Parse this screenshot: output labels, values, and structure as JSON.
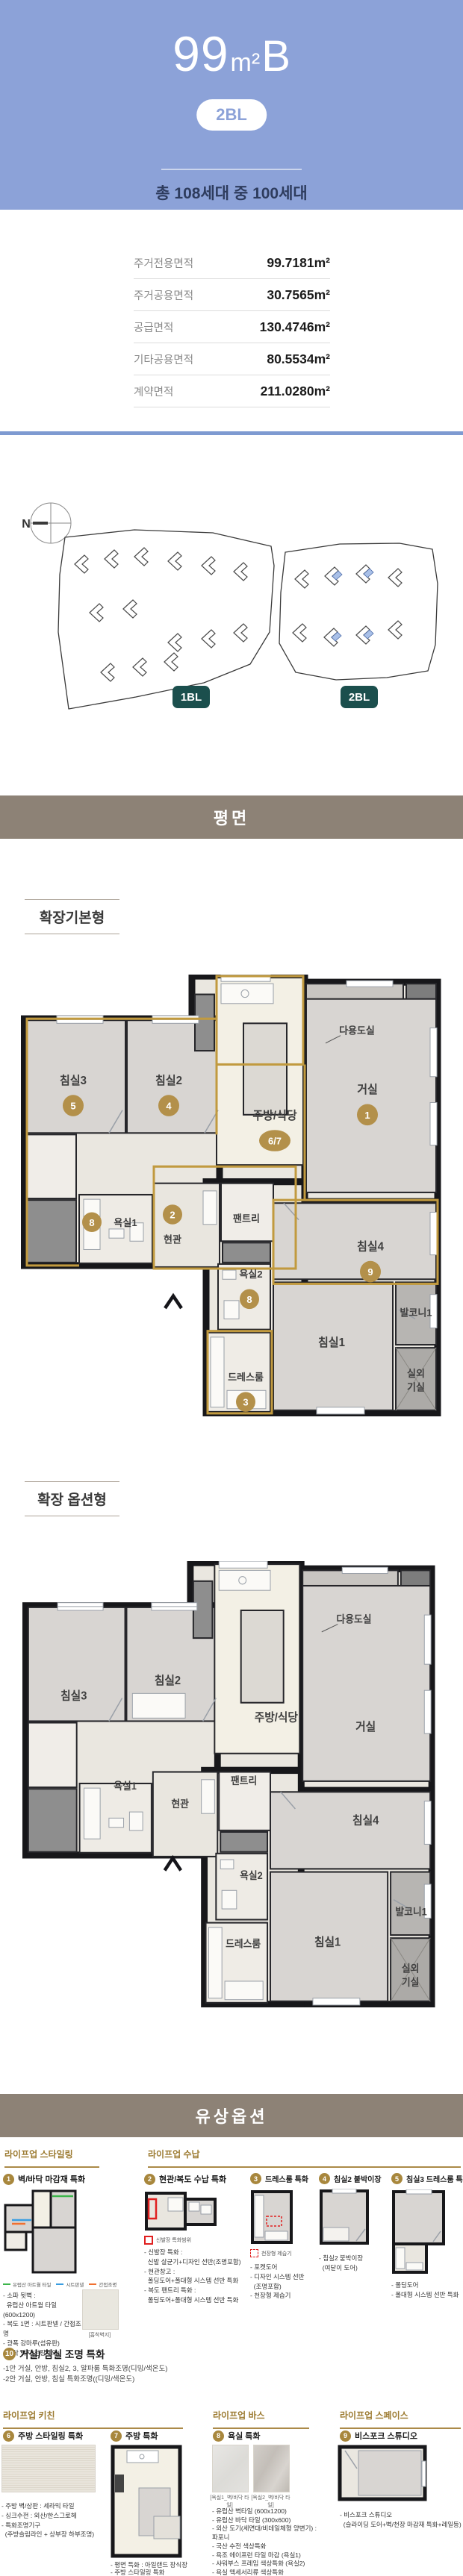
{
  "theme": {
    "header_bg": "#8CA2D8",
    "subtitle_text": "#2E3C5E",
    "band_bg": "#8D8276",
    "accent_gold": "#B3904A",
    "gold_line": "#C19A3F",
    "badge_teal": "#1B4F4D",
    "divider_blue": "#7E9AD1",
    "legend_green": "#3CB54A",
    "legend_blue": "#3B9DE0",
    "legend_orange": "#F07030",
    "legend_red": "#E02020",
    "wall": "#17171A"
  },
  "header": {
    "title_num": "99",
    "title_unit": "m²",
    "title_type": "B",
    "block_badge": "2BL",
    "subtitle": "총 108세대 중 100세대"
  },
  "area_table": {
    "rows": [
      {
        "label": "주거전용면적",
        "value": "99.7181m²"
      },
      {
        "label": "주거공용면적",
        "value": "30.7565m²"
      },
      {
        "label": "공급면적",
        "value": "130.4746m²"
      },
      {
        "label": "기타공용면적",
        "value": "80.5534m²"
      },
      {
        "label": "계약면적",
        "value": "211.0280m²"
      }
    ]
  },
  "site_plan": {
    "compass_label": "N",
    "badges": [
      "1BL",
      "2BL"
    ]
  },
  "sections": {
    "plan_band": "평면",
    "paid_band": "유상옵션"
  },
  "plan_basic": {
    "title": "확장기본형",
    "rooms": {
      "bed3": {
        "label": "침실3",
        "badge": "5"
      },
      "bed2": {
        "label": "침실2",
        "badge": "4"
      },
      "kitchen": {
        "label": "주방/식당",
        "badge": "6/7"
      },
      "living": {
        "label": "거실",
        "badge": "1"
      },
      "bath1": {
        "label": "욕실1",
        "badge": "8"
      },
      "entry": {
        "label": "현관",
        "badge": "2"
      },
      "pantry": {
        "label": "팬트리"
      },
      "bed4": {
        "label": "침실4",
        "badge": "9"
      },
      "bath2": {
        "label": "욕실2",
        "badge": "8"
      },
      "dress": {
        "label": "드레스룸",
        "badge": "3"
      },
      "bed1": {
        "label": "침실1"
      },
      "balcony": {
        "label": "발코니1"
      },
      "outdoor": {
        "label": "실외기실",
        "line1": "실외",
        "line2": "기실"
      },
      "utility": {
        "label": "다용도실"
      }
    }
  },
  "plan_option": {
    "title": "확장 옵션형",
    "rooms": {
      "bed3": {
        "label": "침실3"
      },
      "bed2": {
        "label": "침실2"
      },
      "kitchen": {
        "label": "주방/식당"
      },
      "living": {
        "label": "거실"
      },
      "bath1": {
        "label": "욕실1"
      },
      "entry": {
        "label": "현관"
      },
      "pantry": {
        "label": "팬트리"
      },
      "bed4": {
        "label": "침실4"
      },
      "bath2": {
        "label": "욕실2"
      },
      "dress": {
        "label": "드레스룸"
      },
      "bed1": {
        "label": "침실1"
      },
      "balcony": {
        "label": "발코니1"
      },
      "outdoor": {
        "label": "실외기실",
        "line1": "실외",
        "line2": "기실"
      },
      "utility": {
        "label": "다용도실"
      }
    }
  },
  "options": {
    "groups": {
      "styling": "라이프업 스타일링",
      "storage": "라이프업 수납",
      "kitchen": "라이프업 키친",
      "bath": "라이프업 바스",
      "space": "라이프업 스페이스"
    },
    "items": {
      "i1": {
        "num": "1",
        "title": "벽/바닥 마감재 특화",
        "legend": [
          {
            "color": "#3CB54A",
            "label": "유럽산 아트월 타일"
          },
          {
            "color": "#3B9DE0",
            "label": "시트판넬"
          },
          {
            "color": "#F07030",
            "label": "간접조명"
          }
        ],
        "bullets": [
          "- 소파 뒷벽 :",
          "  유럽산 아트월 타일(600x1200)",
          "- 복도 1면 : 시트판넬 / 간접조명",
          "- 광폭 강마루(섬유판)",
          "- 흡착 벽지(천장제외)"
        ],
        "sample_caption": "[흡착벽지]"
      },
      "i2": {
        "num": "2",
        "title": "현관/복도 수납 특화",
        "legend_label": "신발장 특화범위",
        "bullets": [
          "- 신발장 특화 :",
          "  신발 살균기+디자인 선반(조명포함)",
          "- 현관창고 :",
          "  폴딩도어+폴대형 시스템 선반 특화",
          "- 복도 팬트리 특화 :",
          "  폴딩도어+폴대형 시스템 선반 특화"
        ]
      },
      "i3": {
        "num": "3",
        "title": "드레스룸 특화",
        "legend_label": "천장형 제습기",
        "bullets": [
          "- 포켓도어",
          "- 디자인 시스템 선반",
          "  (조명포함)",
          "- 천장형 제습기"
        ]
      },
      "i4": {
        "num": "4",
        "title": "침실2 붙박이장",
        "bullets": [
          "- 침실2 붙박이장",
          "  (여닫이 도어)"
        ]
      },
      "i5": {
        "num": "5",
        "title": "침실3 드레스룸 특화",
        "bullets": [
          "- 폴딩도어",
          "- 폴대형 시스템 선반 특화"
        ]
      },
      "i10": {
        "num": "10",
        "title": "거실/ 침실 조명 특화",
        "bullets": [
          "-1안 거실, 안방, 침실2, 3, 알파룸 특화조명(디밍/색온도)",
          "-2안 거실, 안방, 침실 특화조명((디밍/색온도)"
        ]
      },
      "i6": {
        "num": "6",
        "title": "주방 스타일링 특화",
        "bullets": [
          "- 주방 벽/상판 : 세라믹 타일",
          "- 싱크수전 : 외산/한스그로헤",
          "- 특화조명기구",
          "  (주방슬림라인 + 상부장 하부조명)"
        ]
      },
      "i7": {
        "num": "7",
        "title": "주방 특화",
        "bullets": [
          "- 평면 특화 : 아일랜드 장식장",
          "- 주방 스타일링 특화"
        ]
      },
      "i8": {
        "num": "8",
        "title": "욕실 특화",
        "captions": [
          "[욕실1_벽/바닥 타일]",
          "[욕실2_벽/바닥 타일]"
        ],
        "bullets": [
          "- 유럽산 벽타일 (600x1200)",
          "- 유럽산 바닥 타일 (300x600)",
          "- 외산 도기(세면대/비데일체형 양변기) : 파포니",
          "- 국산 수전 색상특화",
          "- 욕조 에이프런 타일 마감 (욕실1)",
          "- 샤워부스 프레임 색상특화 (욕실2)",
          "- 욕실 액세서리류 색상특화"
        ]
      },
      "i9": {
        "num": "9",
        "title": "비스포크 스튜디오",
        "bullets": [
          "- 비스포크 스튜디오",
          "  (슬라이딩 도어+벽/천장 마감재 특화+레일등)"
        ]
      }
    }
  }
}
